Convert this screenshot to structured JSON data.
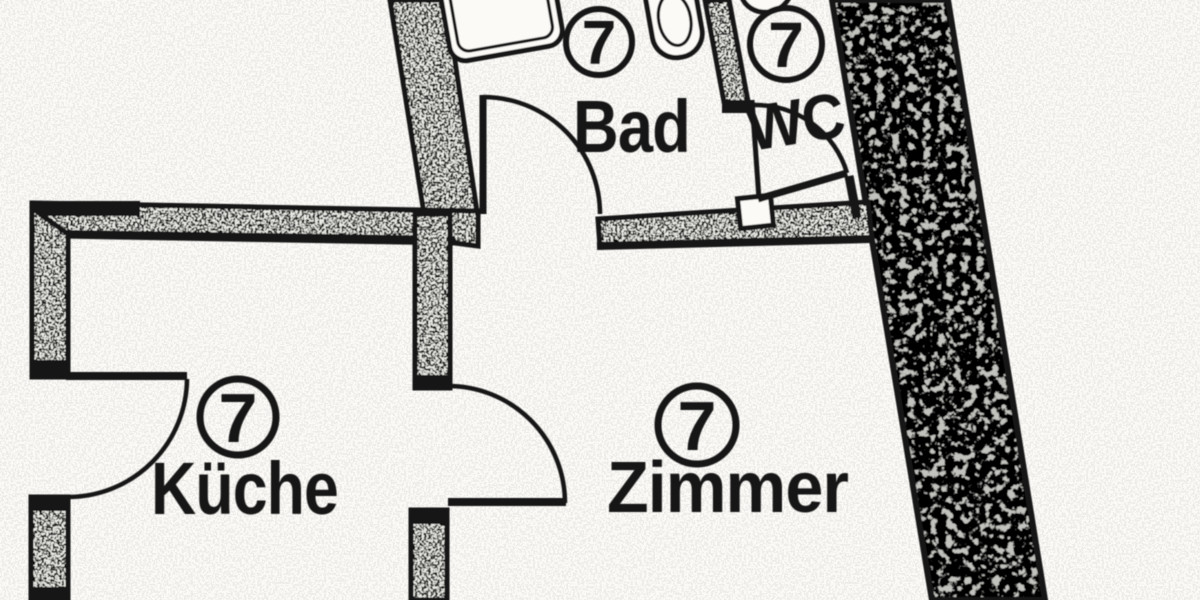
{
  "plan": {
    "rooms": [
      {
        "key": "bad",
        "label": "Bad",
        "number": "7"
      },
      {
        "key": "wc",
        "label": "WC",
        "number": "7"
      },
      {
        "key": "kueche",
        "label": "Küche",
        "number": "7"
      },
      {
        "key": "zimmer",
        "label": "Zimmer",
        "number": "7"
      }
    ]
  },
  "colors": {
    "ink": "#141414",
    "paper": "#fbfaf7",
    "wall_dense": "#c2c2be",
    "wall_light": "#eeeee9"
  }
}
